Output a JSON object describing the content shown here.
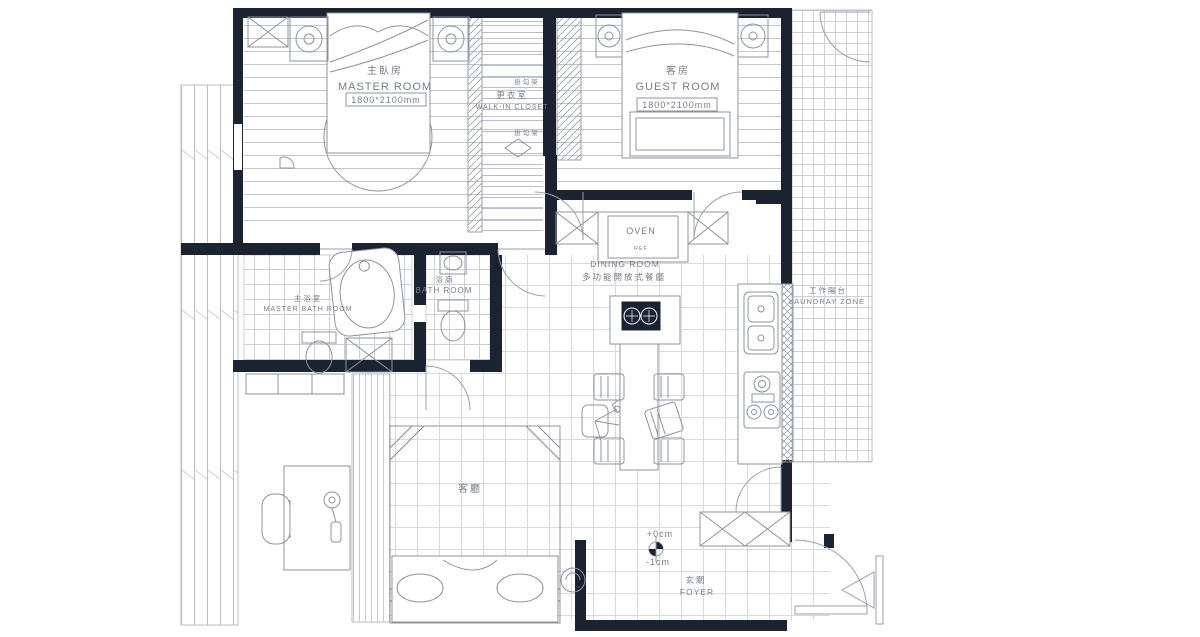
{
  "title": "apartment-floor-plan",
  "colors": {
    "wall": "#1b2230",
    "furniture_line": "#8d939c",
    "tile_line": "#d7dade",
    "plank_line": "#c3c7cd",
    "text": "#787e87"
  },
  "rooms": {
    "master_room": {
      "name_zh": "主臥房",
      "name_en": "MASTER ROOM",
      "bed_size": "1800*2100mm"
    },
    "walk_in_closet": {
      "name_zh": "更衣室",
      "name_en": "WALK-IN CLOSET",
      "rack_top": "掛勾架",
      "rack_bottom": "掛勾架"
    },
    "guest_room": {
      "name_zh": "客房",
      "name_en": "GUEST ROOM",
      "bed_size": "1800*2100mm"
    },
    "dining_room": {
      "name_en": "DINING ROOM",
      "name_zh": "多功能開放式餐廳",
      "oven_label": "OVEN",
      "ref_label": "REF"
    },
    "master_bath": {
      "name_zh": "主浴室",
      "name_en": "MASTER BATH ROOM"
    },
    "bath_room": {
      "name_zh": "浴廁",
      "name_en": "BATH ROOM"
    },
    "laundry_zone": {
      "name_zh": "工作陽台",
      "name_en": "LAUNDRAY ZONE"
    },
    "living_room": {
      "name_zh": "客廳"
    },
    "foyer": {
      "name_zh": "玄關",
      "name_en": "FOYER",
      "level_entry": "+0cm",
      "level_outside": "-1cm"
    }
  }
}
